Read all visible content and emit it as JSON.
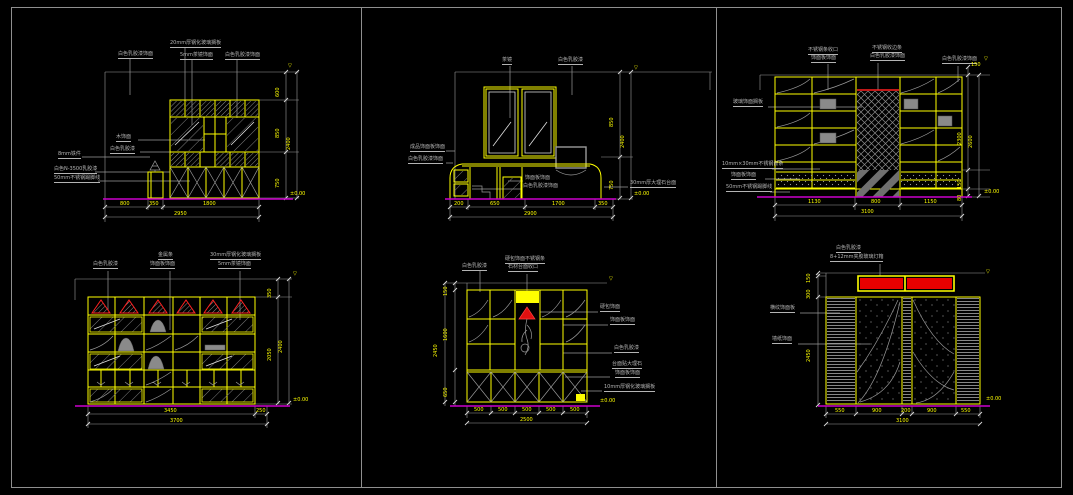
{
  "drawing": {
    "background": "#000000",
    "border_color": "#8f8f8f",
    "colors": {
      "cabinet_line": "#ffff00",
      "dimension_text": "#ffff00",
      "annotation_text": "#b4b4b4",
      "baseline": "#cc00cc",
      "accent_red": "#ff2020",
      "hatch_gray": "#8a8a8a"
    },
    "marks": {
      "ceiling_flag": "▽",
      "floor_level": "±0.00"
    },
    "panels": {
      "bookshelf_a": {
        "labels": [
          "白色乳胶漆饰面",
          "20mm厚钢化玻璃搁板",
          "5mm茶镜饰面",
          "白色乳胶漆饰面",
          "木饰面",
          "白色乳胶漆",
          "8mm铁件",
          "白色N-3500乳胶漆",
          "50mm不锈钢踢脚线"
        ],
        "dims": {
          "bottom": [
            "800",
            "350",
            "1800"
          ],
          "bottom_total": "2950",
          "right": [
            "600",
            "850",
            "750"
          ],
          "right_total": "2400"
        }
      },
      "tv_wall": {
        "labels": [
          "茶镜",
          "白色乳胶漆",
          "成品饰面板饰面",
          "白色乳胶漆饰面",
          "饰面板饰面",
          "白色乳胶漆饰面",
          "30mm厚大理石台面"
        ],
        "dims": {
          "bottom": [
            "200",
            "650",
            "1700",
            "350"
          ],
          "bottom_total": "2900",
          "right": [
            "850",
            "750"
          ],
          "right_total": "2400"
        }
      },
      "wardrobe_wall": {
        "labels": [
          "不锈钢条收口",
          "饰面板饰面",
          "不锈钢收边条",
          "白色乳胶漆饰面",
          "白色乳胶漆饰面",
          "玻璃饰面搁板",
          "10mm×30mm不锈钢嵌条",
          "饰面板饰面",
          "50mm不锈钢踢脚线"
        ],
        "dims": {
          "bottom": [
            "1130",
            "800",
            "1150"
          ],
          "bottom_total": "3100",
          "right_top": "150",
          "right": [
            "2300",
            "150",
            "80"
          ],
          "right_total": "2600"
        }
      },
      "display_shelf": {
        "labels": [
          "白色乳胶漆",
          "金属条",
          "饰面板饰面",
          "30mm厚钢化玻璃搁板",
          "5mm茶镜饰面"
        ],
        "dims": {
          "bottom": [
            "3450",
            "250"
          ],
          "bottom_total": "3700",
          "right": [
            "350",
            "2050"
          ],
          "right_total": "2400"
        }
      },
      "niche_cabinet": {
        "labels": [
          "白色乳胶漆",
          "硬包饰面不锈钢条",
          "石材台面收口",
          "硬包饰面",
          "饰面板饰面",
          "白色乳胶漆",
          "台面贴大理石",
          "饰面板饰面",
          "10mm厚钢化玻璃搁板"
        ],
        "dims": {
          "bottom": [
            "500",
            "500",
            "500",
            "500",
            "500"
          ],
          "bottom_total": "2500",
          "left": [
            "150",
            "1600",
            "650"
          ],
          "left_total": "2450"
        }
      },
      "feature_wall": {
        "labels": [
          "白色乳胶漆",
          "8+12mm夹胶玻璃灯箱",
          "横纹饰面板",
          "墙纸饰面"
        ],
        "dims": {
          "bottom": [
            "550",
            "900",
            "200",
            "900",
            "550"
          ],
          "bottom_total": "3100",
          "left": [
            "150",
            "300",
            "2450"
          ]
        }
      }
    }
  }
}
